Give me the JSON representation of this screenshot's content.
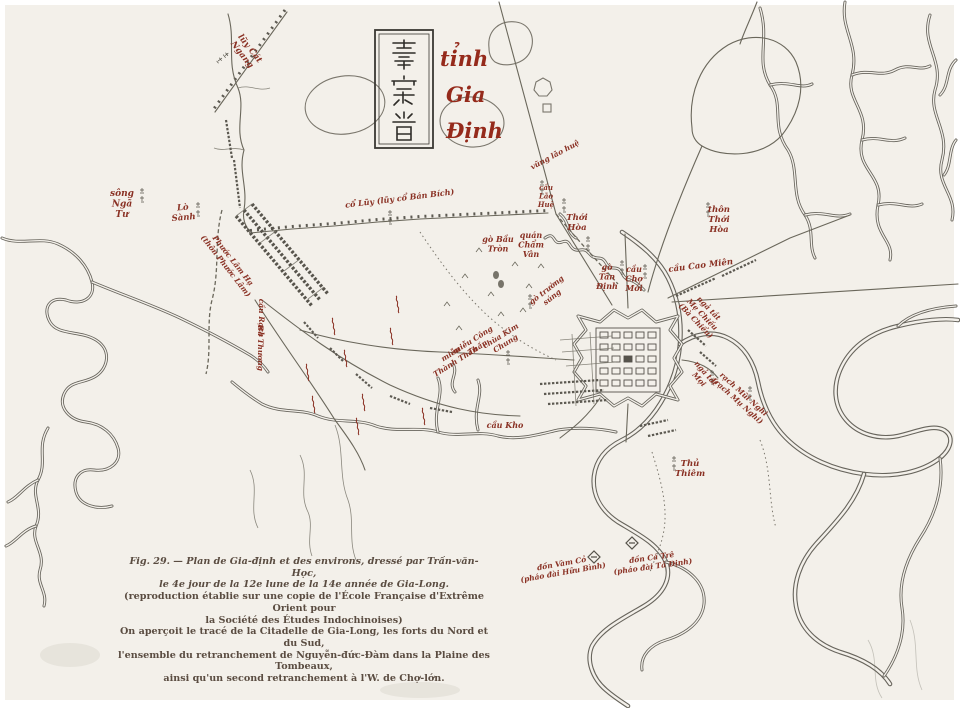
{
  "title": {
    "chinese": "嘉定省",
    "line1": "tỉnh",
    "line2": "Gia",
    "line3": "Định"
  },
  "caption": {
    "lines": [
      "Fig. 29. — Plan de Gia-định et des environs, dressé par Trần-văn-Học,",
      "le 4e jour de la 12e lune de la 14e année de Gia-Long.",
      "(reproduction établie sur une copie de l'École Française d'Extrême Orient pour",
      "la Société des Études Indochinoises)",
      "On aperçoit le tracé de la Citadelle de Gia-Long, les forts du Nord et du Sud,",
      "l'ensemble du retranchement de Nguyễn-đức-Đàm dans la Plaine des Tombeaux,",
      "ainsi qu'un second retranchement à l'W. de Chợ-lớn."
    ]
  },
  "colors": {
    "paper": "#f3f0ea",
    "ink": "#67645c",
    "label_red": "#8a3124",
    "title_red": "#952a1b"
  },
  "labels": [
    {
      "name": "luy-cat-ngang",
      "lines": [
        "lũy Cát",
        "Ngang"
      ],
      "x": 248,
      "y": 50,
      "rot": 52,
      "size": 8.5
    },
    {
      "name": "song-nga-tu",
      "lines": [
        "sông",
        "Ngã",
        "Tư"
      ],
      "x": 122,
      "y": 196,
      "rot": 0,
      "size": 9
    },
    {
      "name": "lo-sanh",
      "lines": [
        "Lò",
        "Sành"
      ],
      "x": 183,
      "y": 210,
      "rot": -5,
      "size": 8.5
    },
    {
      "name": "phuoc-lam-ha",
      "lines": [
        "Phước Lâm Hạ",
        "(thôn Phước Lâm)"
      ],
      "x": 231,
      "y": 262,
      "rot": 52,
      "size": 7.5
    },
    {
      "name": "co-luy-ban-bich",
      "lines": [
        "cổ Lũy (lũy cổ Bán Bích)"
      ],
      "x": 400,
      "y": 201,
      "rot": -7,
      "size": 8
    },
    {
      "name": "vung-lao-hue",
      "lines": [
        "vũng lão huệ"
      ],
      "x": 556,
      "y": 157,
      "rot": -28,
      "size": 7.5,
      "color": "#9aa06e"
    },
    {
      "name": "cau-lao-hue",
      "lines": [
        "cầu",
        "Lão",
        "Huệ"
      ],
      "x": 546,
      "y": 190,
      "rot": 0,
      "size": 7
    },
    {
      "name": "go-bau-tron",
      "lines": [
        "gò Bầu",
        "Tròn"
      ],
      "x": 498,
      "y": 242,
      "rot": 0,
      "size": 8
    },
    {
      "name": "quan-cham-van",
      "lines": [
        "quán",
        "Chẩm",
        "Vân"
      ],
      "x": 531,
      "y": 238,
      "rot": 0,
      "size": 8
    },
    {
      "name": "go-truong-sung",
      "lines": [
        "gò trường",
        "súng"
      ],
      "x": 548,
      "y": 292,
      "rot": -38,
      "size": 7.5
    },
    {
      "name": "thoi-hoa",
      "lines": [
        "Thới",
        "Hòa"
      ],
      "x": 577,
      "y": 220,
      "rot": 0,
      "size": 8.5
    },
    {
      "name": "thon-thoi-hoa",
      "lines": [
        "thôn",
        "Thới",
        "Hòa"
      ],
      "x": 719,
      "y": 212,
      "rot": 0,
      "size": 8.5
    },
    {
      "name": "go-tan-dinh",
      "lines": [
        "gò",
        "Tân",
        "Định"
      ],
      "x": 607,
      "y": 270,
      "rot": 0,
      "size": 8
    },
    {
      "name": "cau-cho-moi",
      "lines": [
        "cầu",
        "Chợ",
        "Mới"
      ],
      "x": 634,
      "y": 272,
      "rot": 0,
      "size": 8
    },
    {
      "name": "cau-cao-mien",
      "lines": [
        "cầu Cao Miên"
      ],
      "x": 701,
      "y": 268,
      "rot": -7,
      "size": 8.5
    },
    {
      "name": "nga-tat-me-chieu",
      "lines": [
        "ngả tắt",
        "Mẹ Chiếu",
        "(Bà Chiểu)"
      ],
      "x": 707,
      "y": 310,
      "rot": 46,
      "size": 7.5
    },
    {
      "name": "nga-tat-moi",
      "lines": [
        "ngả tắt",
        "Mọi"
      ],
      "x": 704,
      "y": 375,
      "rot": 48,
      "size": 7.5
    },
    {
      "name": "rach-mui-nghi",
      "lines": [
        "rạch Mũi Nghi",
        "(rạch Mụ Nghi)"
      ],
      "x": 742,
      "y": 396,
      "rot": 42,
      "size": 7.5
    },
    {
      "name": "mieu-thanh-than",
      "lines": [
        "miễu",
        "Thành Thần"
      ],
      "x": 452,
      "y": 356,
      "rot": -32,
      "size": 7.5
    },
    {
      "name": "mieu-cong-than",
      "lines": [
        "miễu Công",
        "Thần"
      ],
      "x": 474,
      "y": 342,
      "rot": -32,
      "size": 7.5
    },
    {
      "name": "chua-kim-chung",
      "lines": [
        "chùa Kim",
        "Chung"
      ],
      "x": 502,
      "y": 338,
      "rot": -32,
      "size": 7.5
    },
    {
      "name": "cau-kho",
      "lines": [
        "cầu Kho"
      ],
      "x": 505,
      "y": 428,
      "rot": 0,
      "size": 8
    },
    {
      "name": "thu-thiem",
      "lines": [
        "Thủ",
        "Thiêm"
      ],
      "x": 690,
      "y": 466,
      "rot": 0,
      "size": 8.5
    },
    {
      "name": "don-vam-co",
      "lines": [
        "đồn Vàm Cỏ",
        "(pháo đài Hữu Bình)"
      ],
      "x": 562,
      "y": 566,
      "rot": -10,
      "size": 7.5
    },
    {
      "name": "don-ca-tre",
      "lines": [
        "đồn Cá Trê",
        "(pháo đài Tả Định)"
      ],
      "x": 652,
      "y": 560,
      "rot": -8,
      "size": 7.5
    },
    {
      "name": "cau-rach",
      "lines": [
        "cầu Rạch"
      ],
      "x": 259,
      "y": 318,
      "rot": 90,
      "size": 7.5
    },
    {
      "name": "ba-thuong",
      "lines": [
        "Bà Thương"
      ],
      "x": 258,
      "y": 348,
      "rot": 90,
      "size": 7.5
    }
  ]
}
